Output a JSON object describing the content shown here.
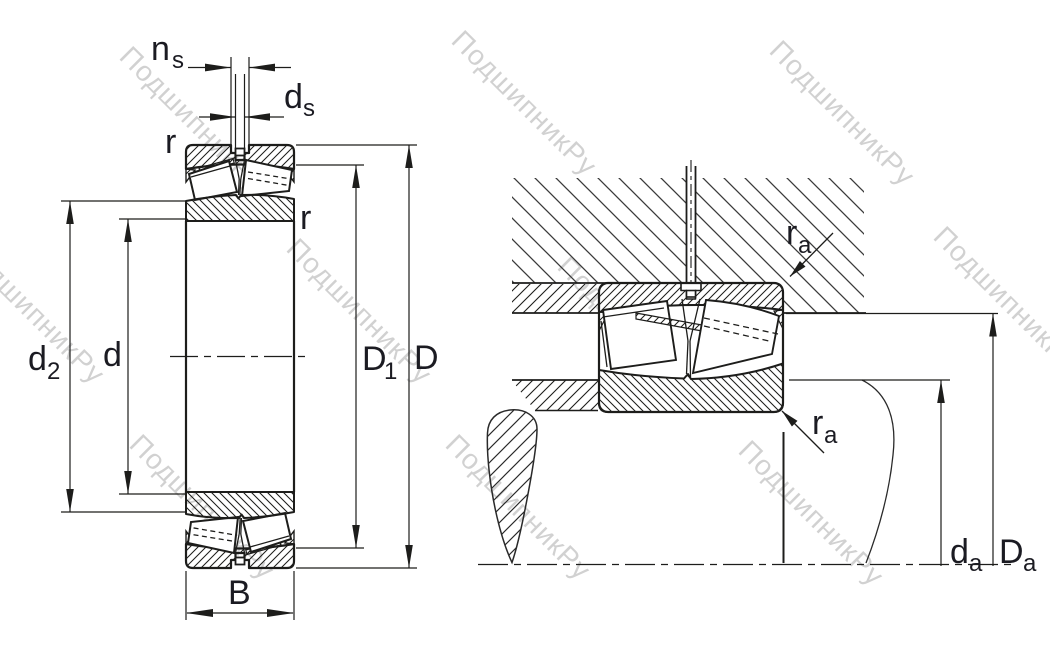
{
  "figure": "spherical-roller-bearing-dimension-drawing",
  "watermark": {
    "text": "ПодшипникРу",
    "color": "#c9c9c9"
  },
  "colors": {
    "line": "#1d1d1b",
    "label": "#1b1b22",
    "background": "#ffffff"
  },
  "left_view": {
    "description": "bearing cross-section with boundary dimensions",
    "labels": {
      "ns": {
        "main": "n",
        "sub": "s"
      },
      "ds": {
        "main": "d",
        "sub": "s"
      },
      "r_top": "r",
      "r_side": "r",
      "d2": {
        "main": "d",
        "sub": "2"
      },
      "d": "d",
      "d1": {
        "main": "D",
        "sub": "1"
      },
      "dcap": "D",
      "b": "B"
    }
  },
  "right_view": {
    "description": "mounted bearing with abutment dimensions",
    "labels": {
      "ra_top": {
        "main": "r",
        "sub": "a"
      },
      "ra_bottom": {
        "main": "r",
        "sub": "a"
      },
      "da": {
        "main": "d",
        "sub": "a"
      },
      "dda": {
        "main": "D",
        "sub": "a"
      }
    }
  }
}
